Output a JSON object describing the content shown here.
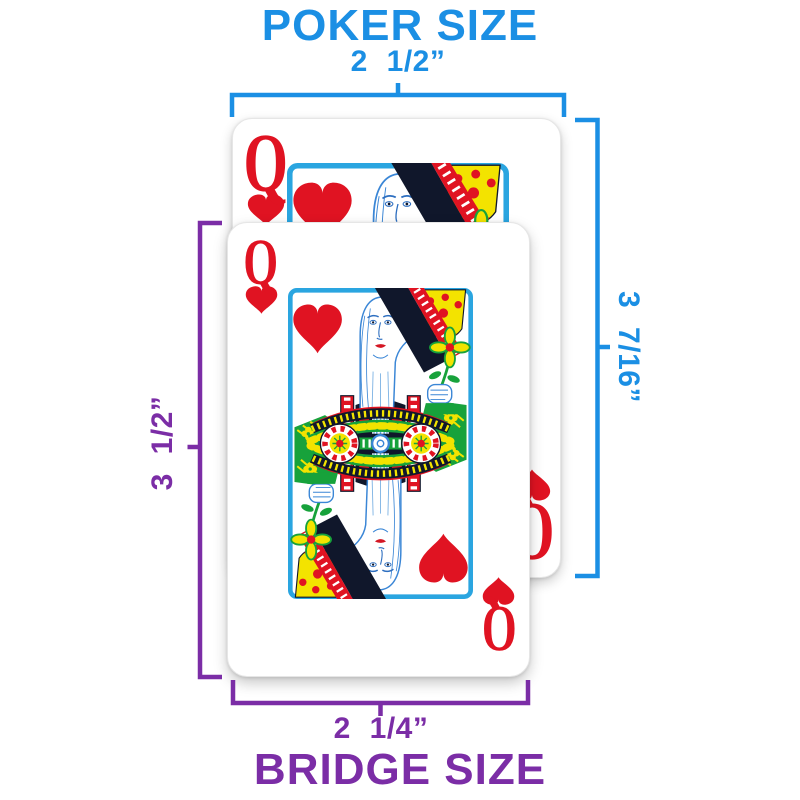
{
  "poker": {
    "title": "POKER SIZE",
    "width_label": "2 1/2”",
    "height_label": "3 7/16”"
  },
  "bridge": {
    "title": "BRIDGE SIZE",
    "width_label": "2 1/4”",
    "height_label": "3 1/2”"
  },
  "card": {
    "rank": "Q",
    "suit": "hearts",
    "suit_icon": "heart-icon"
  },
  "colors": {
    "poker_accent": "#1B8FE4",
    "bridge_accent": "#7B2DA6",
    "card_red": "#E01322",
    "frame_blue": "#2AA5E0",
    "garment_green": "#17A23B",
    "crown_yellow": "#F3E300",
    "sash_navy": "#10172B",
    "face_line_blue": "#3A86D6"
  }
}
